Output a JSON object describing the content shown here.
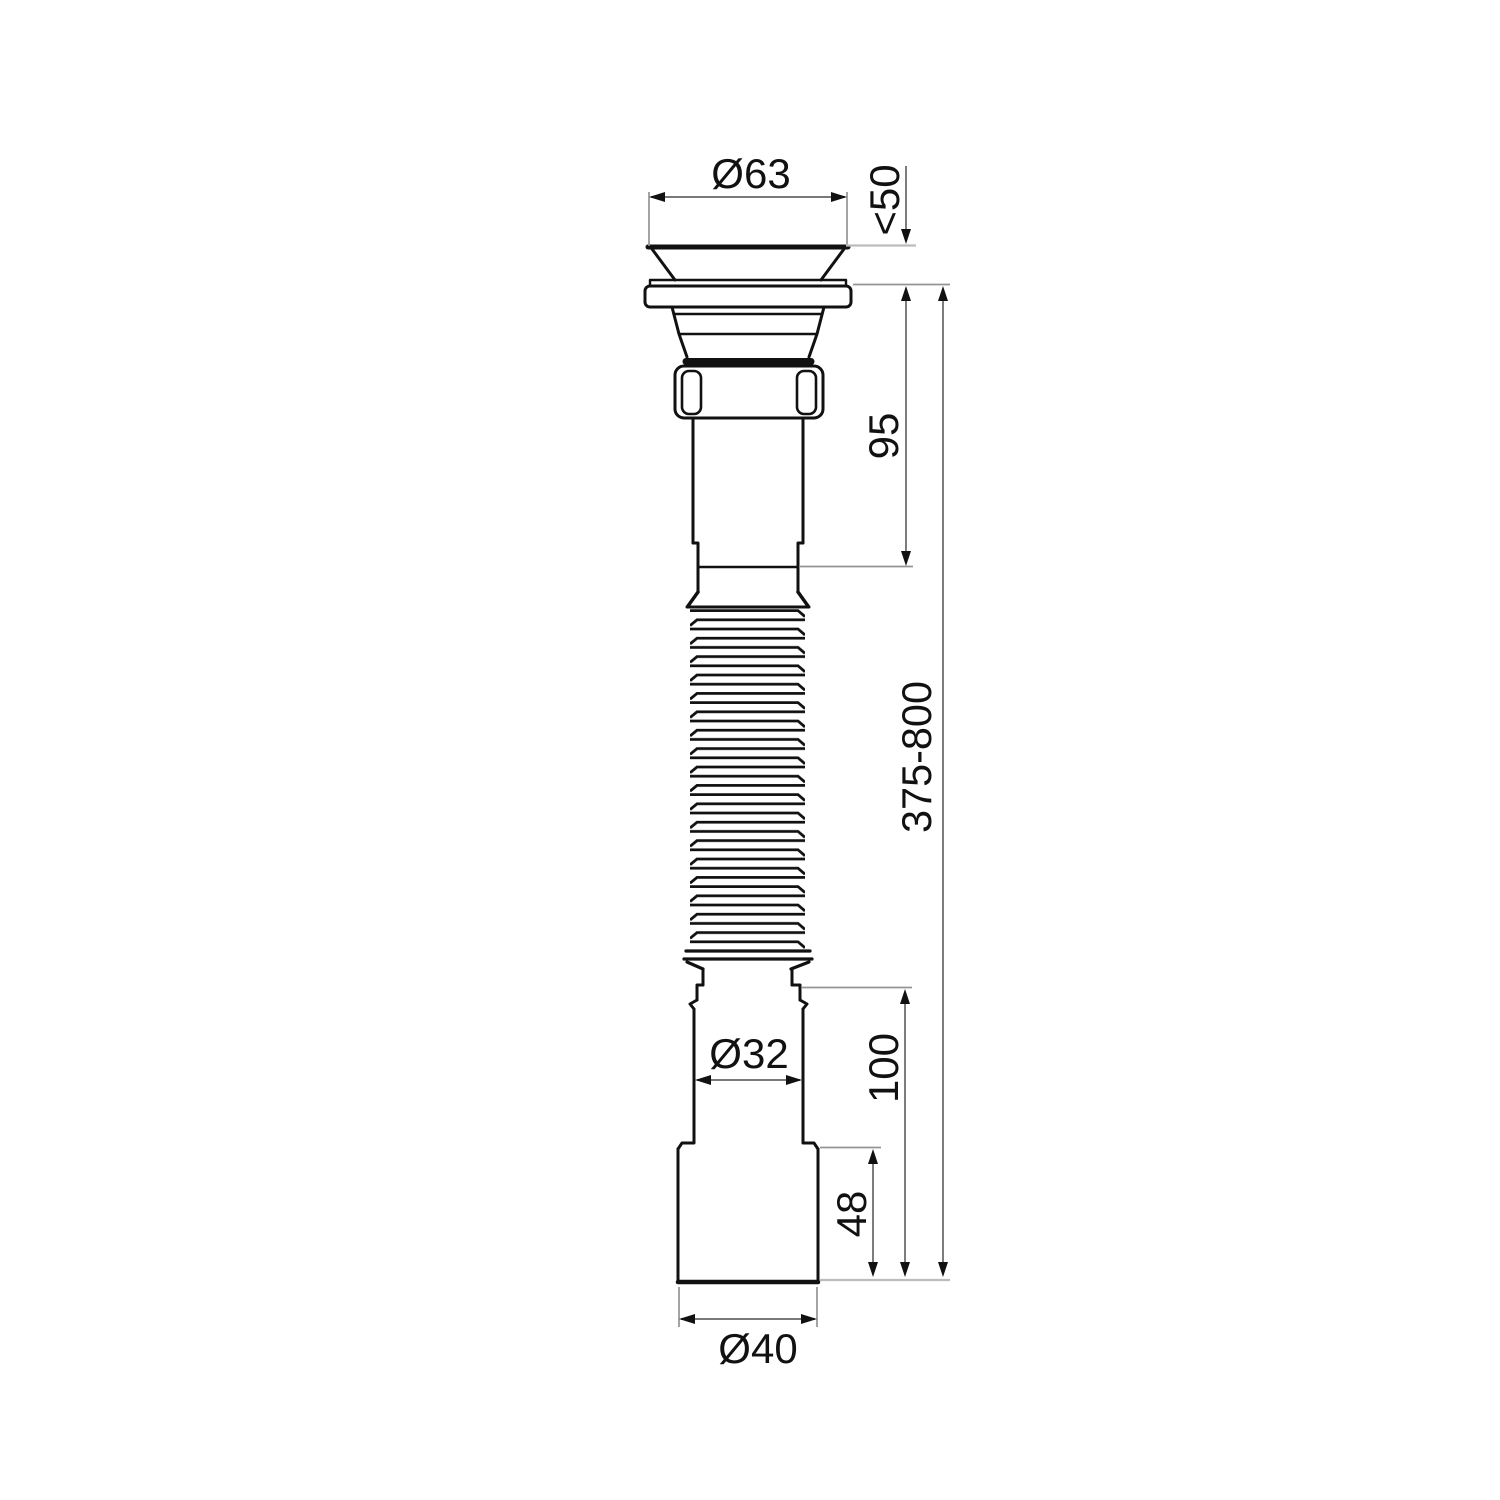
{
  "drawing": {
    "type": "technical-dimension-drawing",
    "subject": "flexible corrugated sink drain with strainer",
    "background_color": "#ffffff",
    "outline_color": "#111111",
    "dimension_line_color": "#666666",
    "extension_line_color": "#bcbcbc",
    "labels": {
      "flange_diameter": "Ø63",
      "mounting_thickness_max": "<50",
      "tailpiece_length": "95",
      "adjustable_length": "375-800",
      "outlet_pipe_diameter": "Ø32",
      "outlet_length": "100",
      "outlet_tip_length": "48",
      "outlet_tip_diameter": "Ø40"
    }
  }
}
